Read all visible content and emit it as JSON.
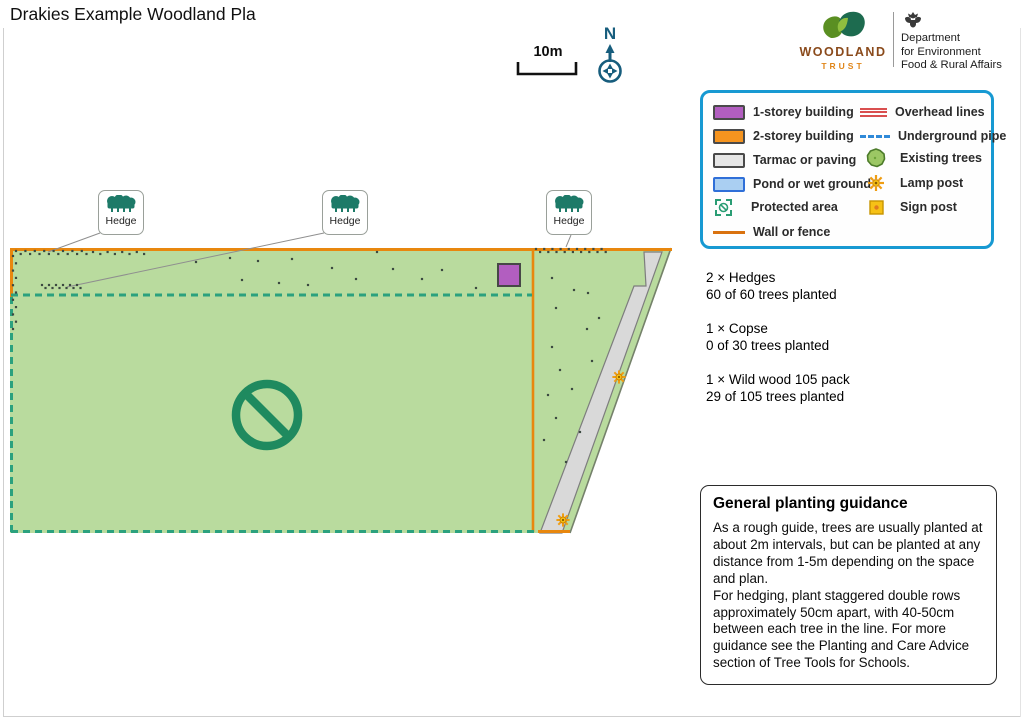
{
  "header": {
    "title": "Drakies Example Woodland Pla"
  },
  "scalebar": {
    "label": "10m"
  },
  "compass": {
    "label": "N"
  },
  "logos": {
    "woodland_trust": {
      "line1": "WOODLAND",
      "line2": "TRUST"
    },
    "defra": {
      "line1": "Department",
      "line2": "for Environment",
      "line3": "Food & Rural Affairs"
    }
  },
  "legend": {
    "left": [
      {
        "label": "1-storey building"
      },
      {
        "label": "2-storey building"
      },
      {
        "label": "Tarmac or paving"
      },
      {
        "label": "Pond or wet ground"
      },
      {
        "label": "Protected area"
      },
      {
        "label": "Wall or fence"
      }
    ],
    "right": [
      {
        "label": "Overhead lines"
      },
      {
        "label": "Underground pipe"
      },
      {
        "label": "Existing trees"
      },
      {
        "label": "Lamp post"
      },
      {
        "label": "Sign post"
      }
    ]
  },
  "summary": {
    "items": [
      {
        "qty": "2 × Hedges",
        "status": "60 of 60 trees planted"
      },
      {
        "qty": "1 × Copse",
        "status": "0 of 30 trees planted"
      },
      {
        "qty": "1 × Wild wood 105 pack",
        "status": "29 of 105 trees planted"
      }
    ]
  },
  "guidance": {
    "title": "General planting guidance",
    "p1": "As a rough guide, trees are usually planted at about 2m intervals, but can be planted at any distance from 1-5m depending on the space and plan.",
    "p2": "For hedging, plant staggered double rows approximately 50cm apart, with 40-50cm between each tree in the line. For more guidance see the Planting and Care Advice section of Tree Tools for Schools."
  },
  "colors": {
    "field_green": "#b9db9e",
    "fence_orange": "#e8870e",
    "protected_teal": "#2ba17e",
    "prohibition_green": "#1f8a5f",
    "hedge_teal": "#1d7a68",
    "building_purple": "#b25ec0",
    "path_grey": "#d9d9d9",
    "tree_dot": "#3c4a41",
    "legend_blue": "#1799d2",
    "lamp_orange": "#ef9d13",
    "sign_yellow": "#f6c116"
  },
  "map": {
    "hedge_label_text": "Hedge",
    "hedge_labels": [
      {
        "x": 98,
        "y": 190
      },
      {
        "x": 322,
        "y": 190
      },
      {
        "x": 546,
        "y": 190
      }
    ],
    "leader_lines": [
      [
        100,
        233,
        48,
        252
      ],
      [
        324,
        233,
        67,
        287
      ],
      [
        571,
        235,
        566,
        247
      ]
    ],
    "tree_rows": [
      {
        "x": 16,
        "y": 251,
        "dx": 4.7,
        "count": 16,
        "stagger": 3
      },
      {
        "x": 93,
        "y": 252,
        "dx": 7.3,
        "count": 8,
        "stagger": 2
      },
      {
        "x": 13,
        "y": 256,
        "dy": 7.3,
        "count": 11,
        "stagger": 3,
        "vertical": true
      },
      {
        "x": 42,
        "y": 285,
        "dx": 3.5,
        "count": 12,
        "stagger": 3
      },
      {
        "x": 536,
        "y": 249,
        "dx": 4.1,
        "count": 18,
        "stagger": 3
      }
    ],
    "scattered_trees": [
      [
        196,
        262
      ],
      [
        230,
        258
      ],
      [
        242,
        280
      ],
      [
        258,
        261
      ],
      [
        279,
        283
      ],
      [
        292,
        259
      ],
      [
        308,
        285
      ],
      [
        332,
        268
      ],
      [
        356,
        279
      ],
      [
        377,
        252
      ],
      [
        393,
        269
      ],
      [
        422,
        279
      ],
      [
        442,
        270
      ],
      [
        476,
        288
      ],
      [
        552,
        278
      ],
      [
        574,
        290
      ],
      [
        588,
        293
      ],
      [
        556,
        308
      ],
      [
        599,
        318
      ],
      [
        587,
        329
      ],
      [
        552,
        347
      ],
      [
        592,
        361
      ],
      [
        560,
        370
      ],
      [
        572,
        389
      ],
      [
        548,
        395
      ],
      [
        556,
        418
      ],
      [
        580,
        432
      ],
      [
        544,
        440
      ],
      [
        566,
        462
      ]
    ],
    "lamp_posts": [
      [
        619,
        377
      ],
      [
        563,
        520
      ]
    ],
    "building": {
      "x": 498,
      "y": 264,
      "w": 22,
      "h": 22
    }
  }
}
